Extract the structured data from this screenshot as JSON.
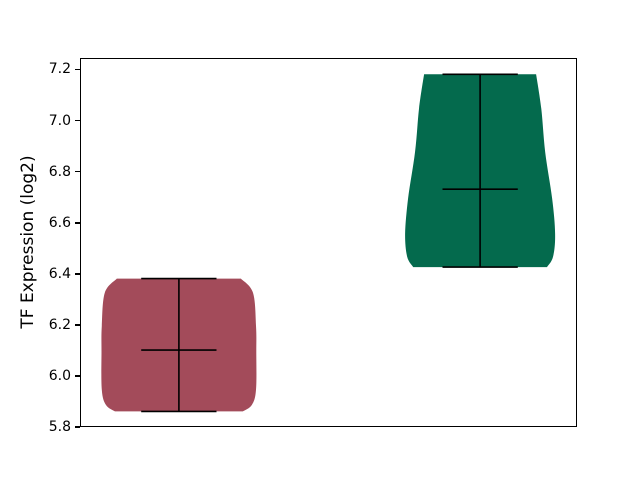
{
  "figure": {
    "background": "#ffffff"
  },
  "chart_data": {
    "type": "violin",
    "title": "",
    "xlabel": "",
    "ylabel": "TF Expression (log2)",
    "grid": false,
    "legend": null,
    "ylim": [
      5.8,
      7.245
    ],
    "xlim": [
      0.675,
      2.325
    ],
    "yticks": [
      5.8,
      6.0,
      6.2,
      6.4,
      6.6,
      6.8,
      7.0,
      7.2
    ],
    "ytick_labels": [
      "5.8",
      "6.0",
      "6.2",
      "6.4",
      "6.6",
      "6.8",
      "7.0",
      "7.2"
    ],
    "xtick_labels": [],
    "line_color": "#000000",
    "series": [
      {
        "name": "violin-1",
        "position": 1,
        "color": "#A34B5A",
        "min": 5.865,
        "max": 6.385,
        "mean": 6.105,
        "cap_halfwidth": 0.125,
        "profile": [
          [
            6.385,
            0.206
          ],
          [
            6.33,
            0.246
          ],
          [
            6.2,
            0.256
          ],
          [
            6.1,
            0.257
          ],
          [
            5.95,
            0.256
          ],
          [
            5.89,
            0.242
          ],
          [
            5.865,
            0.212
          ]
        ]
      },
      {
        "name": "violin-2",
        "position": 2,
        "color": "#046A4D",
        "min": 6.43,
        "max": 7.185,
        "mean": 6.735,
        "cap_halfwidth": 0.125,
        "profile": [
          [
            7.185,
            0.186
          ],
          [
            7.05,
            0.203
          ],
          [
            6.88,
            0.216
          ],
          [
            6.7,
            0.239
          ],
          [
            6.56,
            0.249
          ],
          [
            6.47,
            0.242
          ],
          [
            6.43,
            0.222
          ]
        ]
      }
    ]
  }
}
